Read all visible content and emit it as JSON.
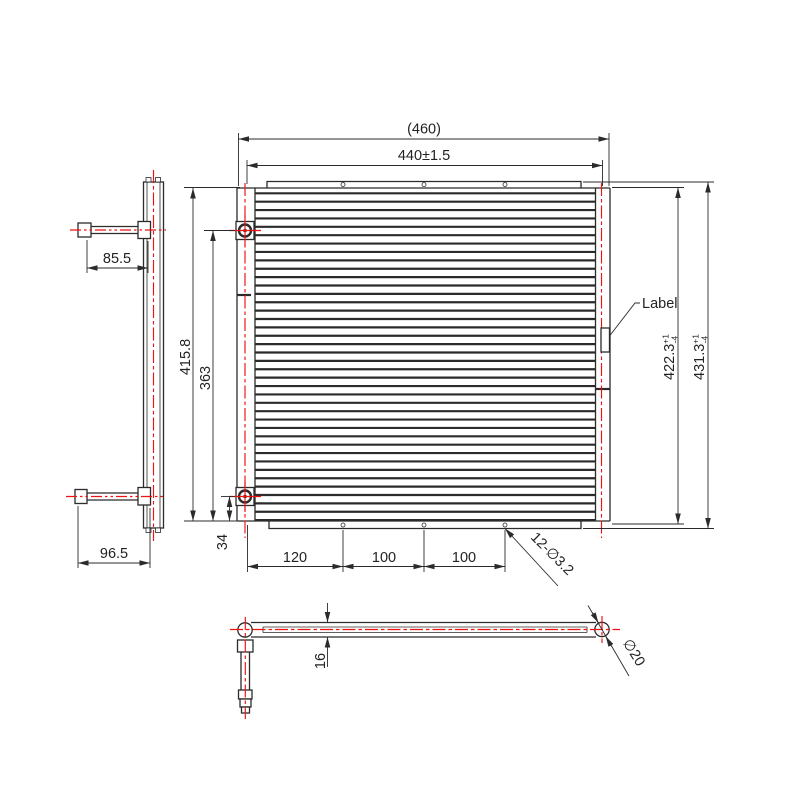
{
  "drawing": {
    "colors": {
      "line": "#2b2b2b",
      "centerline": "#f01111",
      "background": "#ffffff"
    },
    "dims": {
      "overall_width": "(460)",
      "mount_width": "440±1.5",
      "top_tube_length": "85.5",
      "bottom_tube_length": "96.5",
      "core_height": "415.8",
      "port_span": "363",
      "port_bottom_offset": "34",
      "hole_pitch_1": "120",
      "hole_pitch_2": "100",
      "hole_pitch_3": "100",
      "mount_holes": "12-∅3.2",
      "label": "Label",
      "height_to_plate": "422.3",
      "height_to_plate_tol_plus": "+1",
      "height_to_plate_tol_minus": "-4",
      "height_overall": "431.3",
      "height_overall_tol_plus": "+1",
      "height_overall_tol_minus": "-4",
      "tube_height": "16",
      "tube_diameter": "∅20"
    }
  }
}
